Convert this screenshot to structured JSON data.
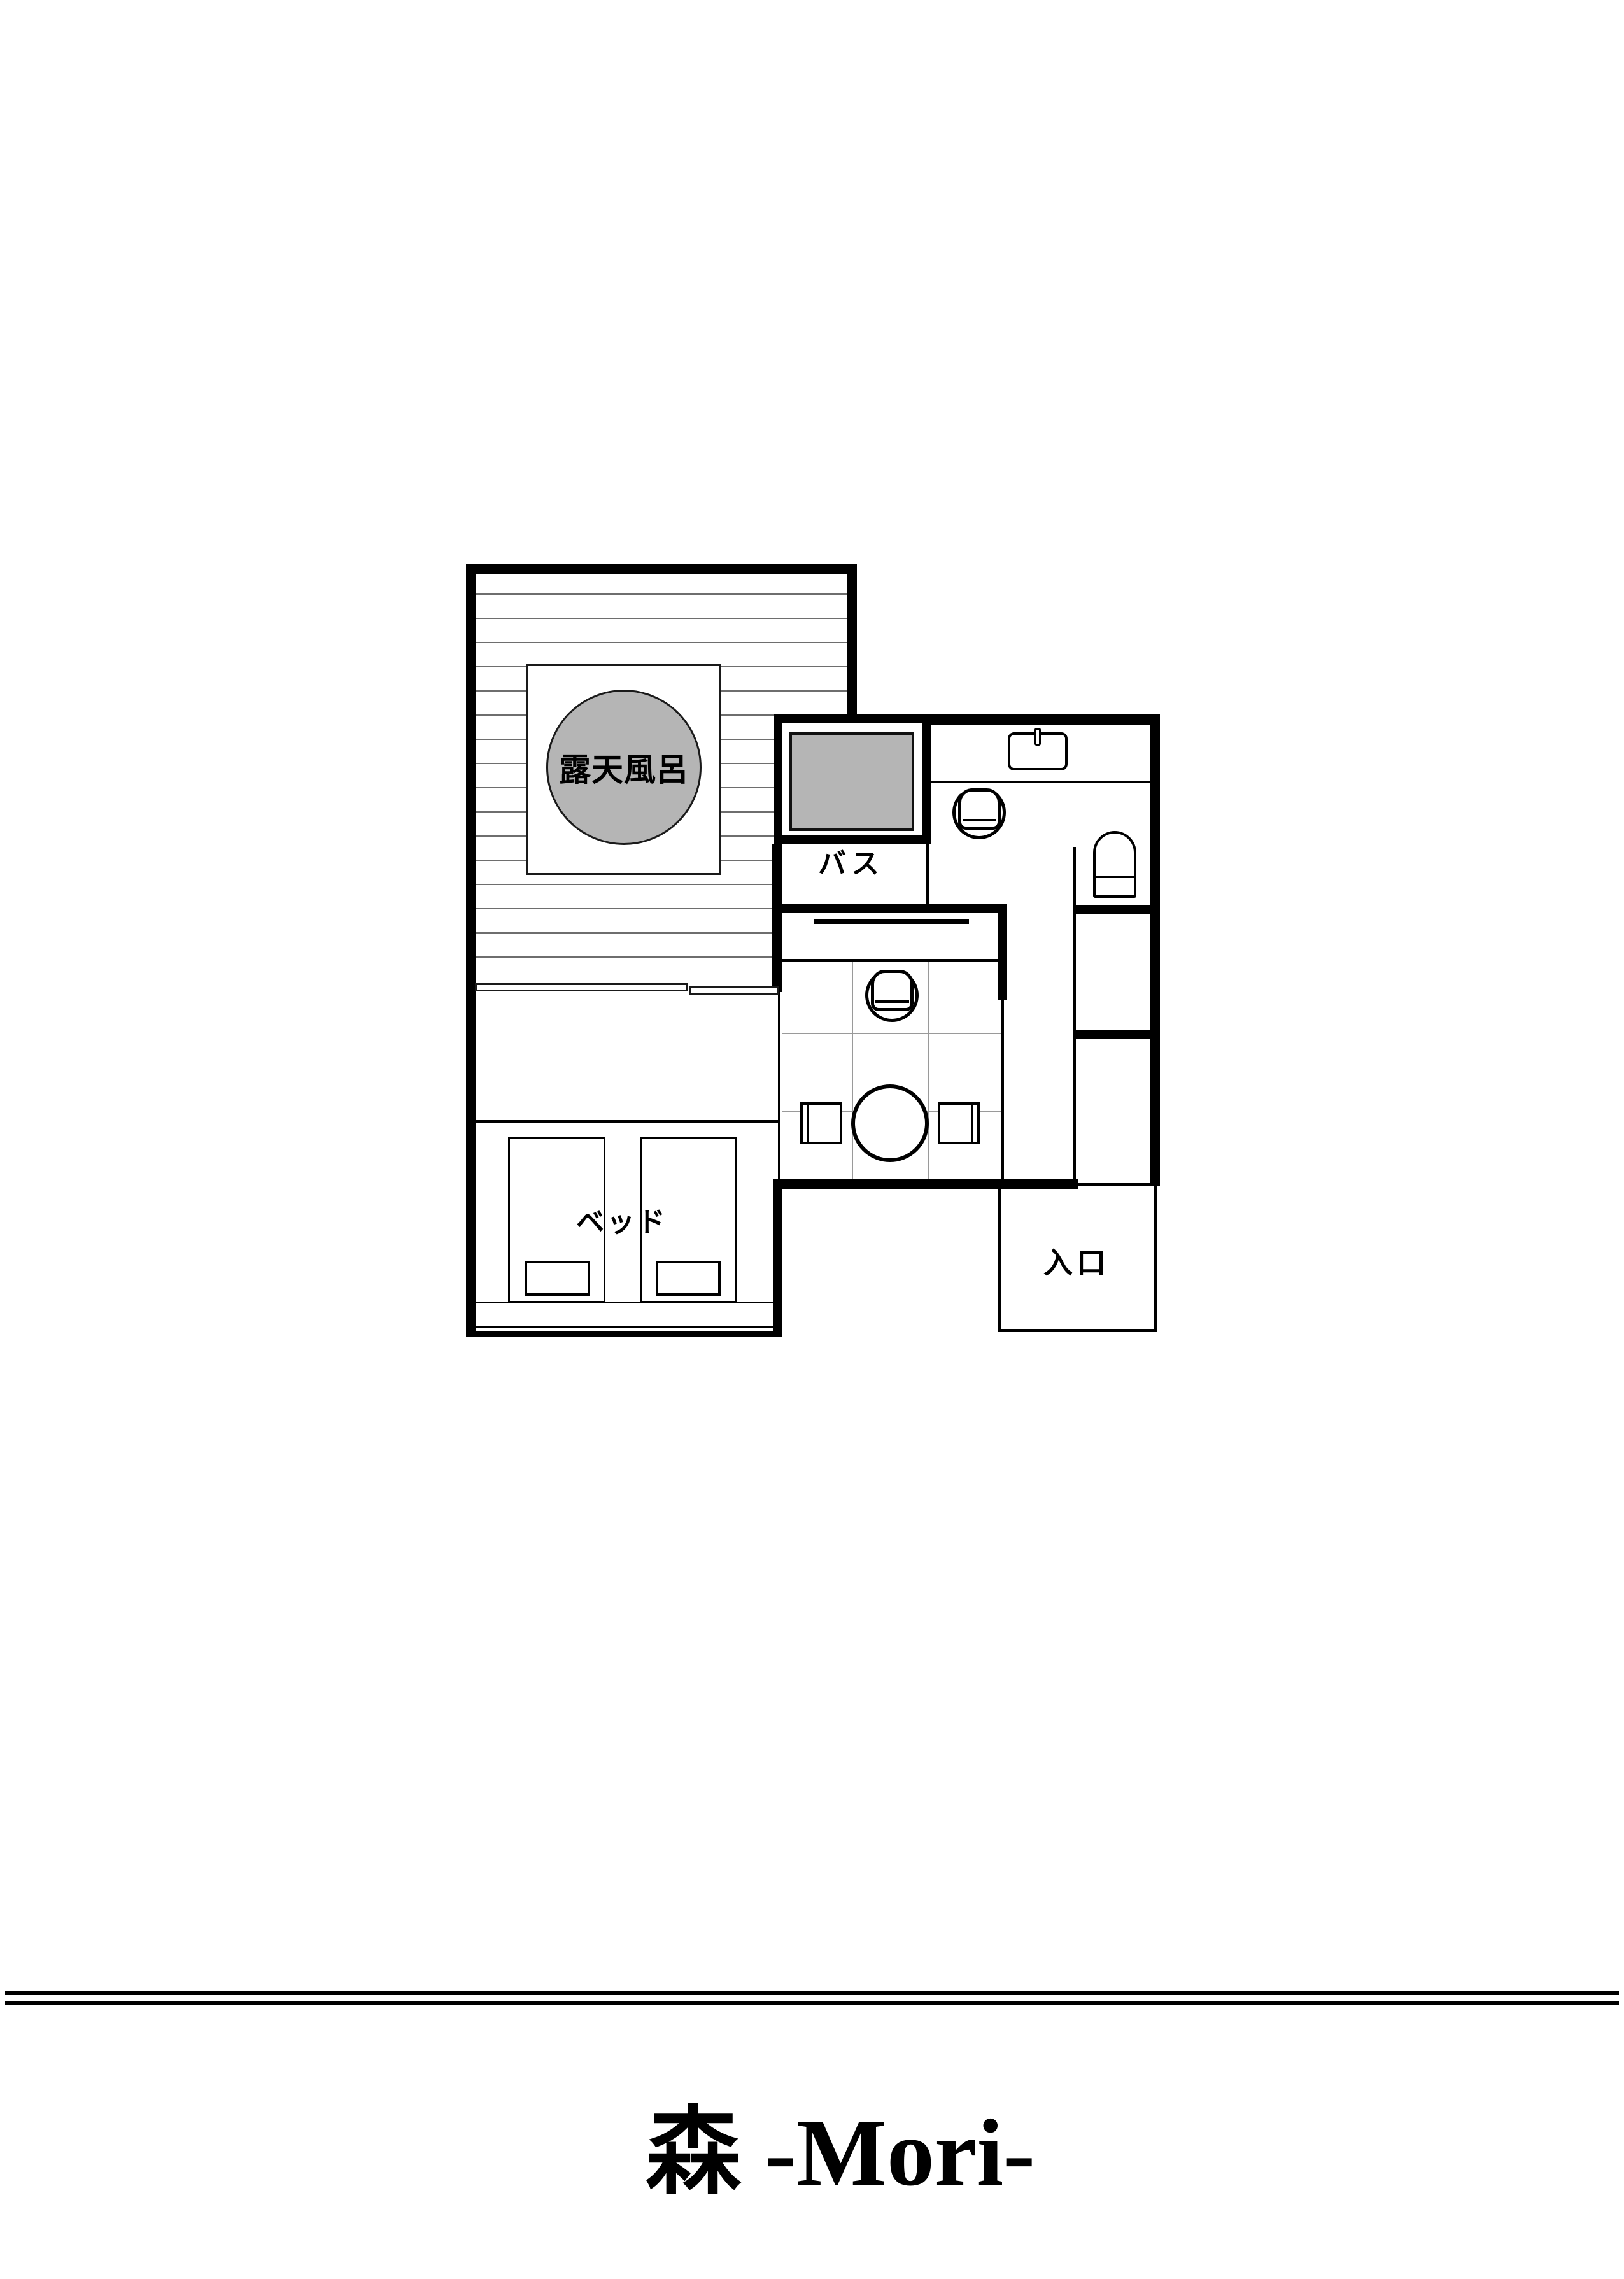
{
  "title": {
    "text": "森 -Mori-"
  },
  "floor_plan": {
    "labels": {
      "outdoor_bath": "露天風呂",
      "bath": "バス",
      "bed": "ベッド",
      "entrance": "入口"
    },
    "colors": {
      "line": "#000000",
      "fixture_gray": "#b5b5b5",
      "deck_stripe": "#6e6e6e",
      "tatami_grid": "#9a9a9a"
    }
  }
}
